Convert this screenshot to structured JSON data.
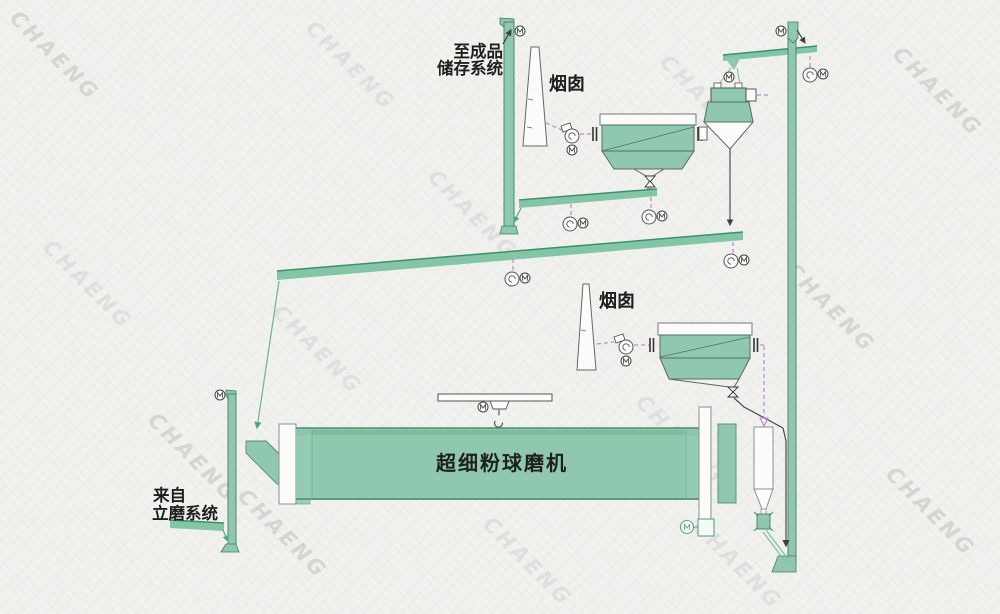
{
  "labels": {
    "to_storage_line1": "至成品",
    "to_storage_line2": "储存系统",
    "chimney1": "烟囱",
    "chimney2": "烟囱",
    "mill": "超细粉球磨机",
    "from_mill_line1": "来自",
    "from_mill_line2": "立磨系统"
  },
  "watermark": {
    "text": "CHAENG"
  },
  "colors": {
    "equipment_green": "#8fc8ae",
    "conveyor_green": "#82c6a6",
    "edge_green": "#3f8e6d",
    "duct_magenta": "#bf85d2",
    "outline_gray": "#5a6a62",
    "line_dark": "#404040",
    "background": "#f1f1ee"
  }
}
